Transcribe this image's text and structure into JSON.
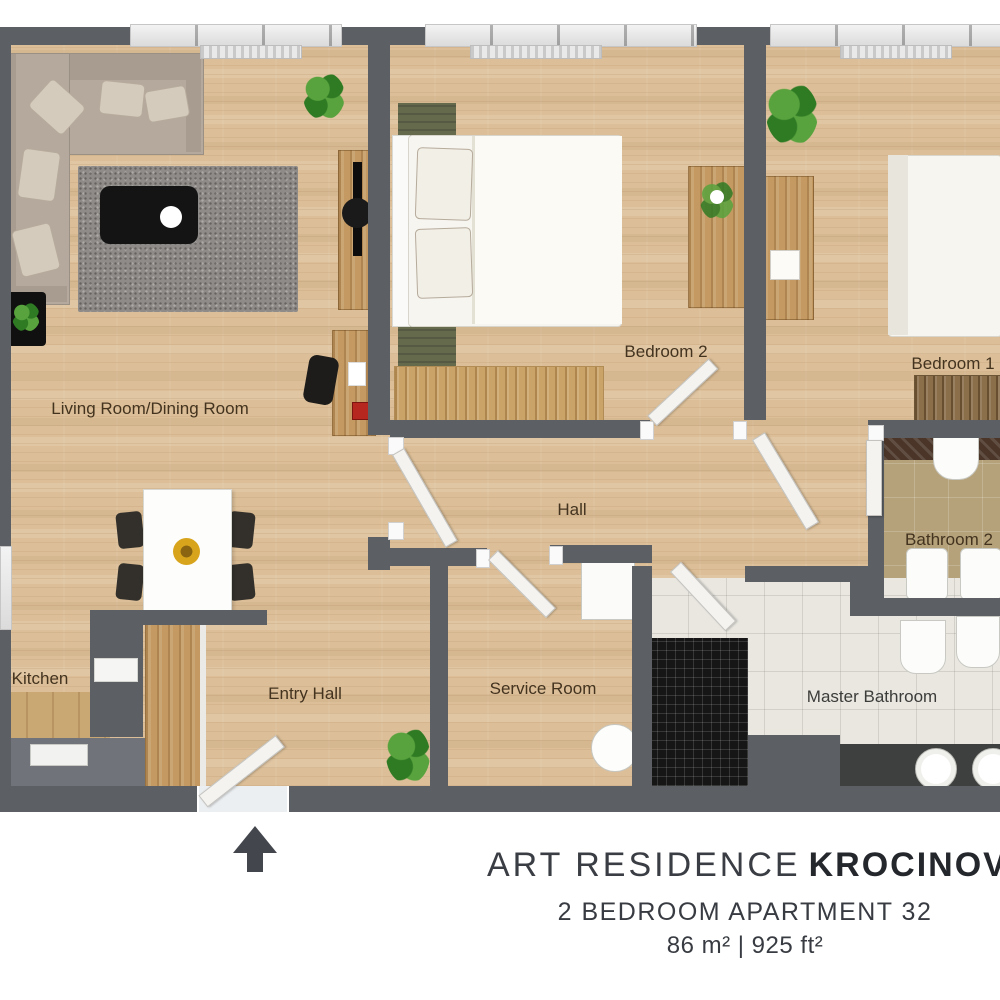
{
  "plan": {
    "rooms": {
      "living": "Living Room/Dining Room",
      "bedroom2": "Bedroom 2",
      "bedroom1": "Bedroom 1",
      "hall": "Hall",
      "bathroom2": "Bathroom 2",
      "kitchen": "Kitchen",
      "entry": "Entry Hall",
      "service": "Service Room",
      "master": "Master Bathroom"
    }
  },
  "title": {
    "name_light": "ART RESIDENCE",
    "name_bold": "KROCINOVA",
    "subtitle": "2 BEDROOM APARTMENT 32",
    "area": "86 m² | 925 ft²"
  },
  "colors": {
    "wall": "#5c6065",
    "wood_floor": "#dcbf98",
    "bath2_floor": "#b5a27a",
    "master_floor": "#e9e7e0",
    "shower_mosaic": "#161616",
    "rug": "#8f8b88",
    "sofa": "#b4a99c",
    "plant": "#3f9130",
    "label_text": "#43331f",
    "title_text": "#3a3e44"
  },
  "icons": {
    "entrance_arrow": "up-arrow"
  }
}
